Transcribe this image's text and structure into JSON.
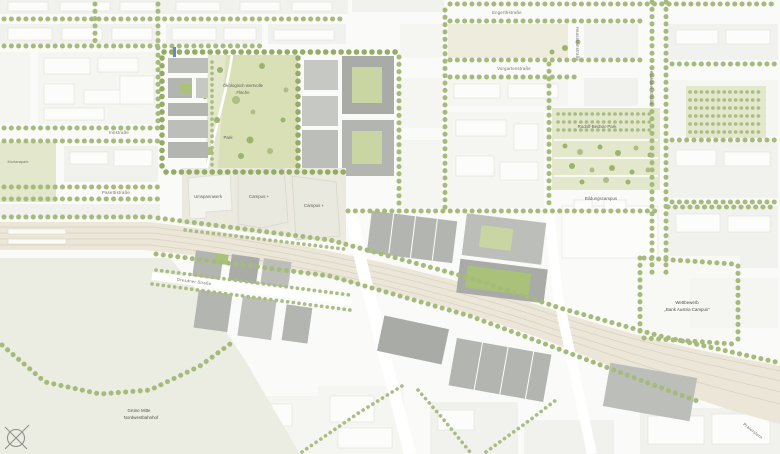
{
  "map": {
    "labels": {
      "eco_area_lines": [
        "Ökologisch wertvolle",
        "Fläche"
      ],
      "park": "Park",
      "umspannwerk": "Umspannwerk",
      "campus_plus_1": "Campus +",
      "campus_plus_2": "Campus +",
      "rudolf_bednar_park": "Rudolf-Bednar-Park",
      "bildungscampus": "Bildungscampus",
      "wettbewerb_lines": [
        "Wettbewerb",
        "„Bank Austria Campus“"
      ],
      "gruene_mitte_lines": [
        "Grüne Mitte",
        "Nordwestbahnhof"
      ],
      "mortarapark": "Mortarapark"
    },
    "streets": {
      "engerthstrasse": "Engerthstraße",
      "vorgartenstrasse": "Vorgartenstraße",
      "haussteinstrasse": "Haussteinstraße",
      "krakauer_strasse": "Krakauer Straße",
      "innstrasse": "Innstraße",
      "pasettistrasse": "Pasettistraße",
      "dresdner_strasse": "Dresdner Straße",
      "praterstern": "Praterstern"
    },
    "icons": {
      "north_arrow": "circle-with-cross compass mark",
      "transit_stop": "blue stop dash"
    },
    "palette": {
      "tree_green": "#a6ba7c",
      "dark_tree_green": "#93ab63",
      "park_green": "#e3e8cd",
      "meadow_green": "#d9e0b6",
      "rail_beige": "#ebe6d8",
      "plan_building_gray": "#b3b5b1",
      "fabric_gray": "#f1f1ee",
      "label_gray": "#6e6e67",
      "stop_blue": "#6a86c9"
    }
  }
}
